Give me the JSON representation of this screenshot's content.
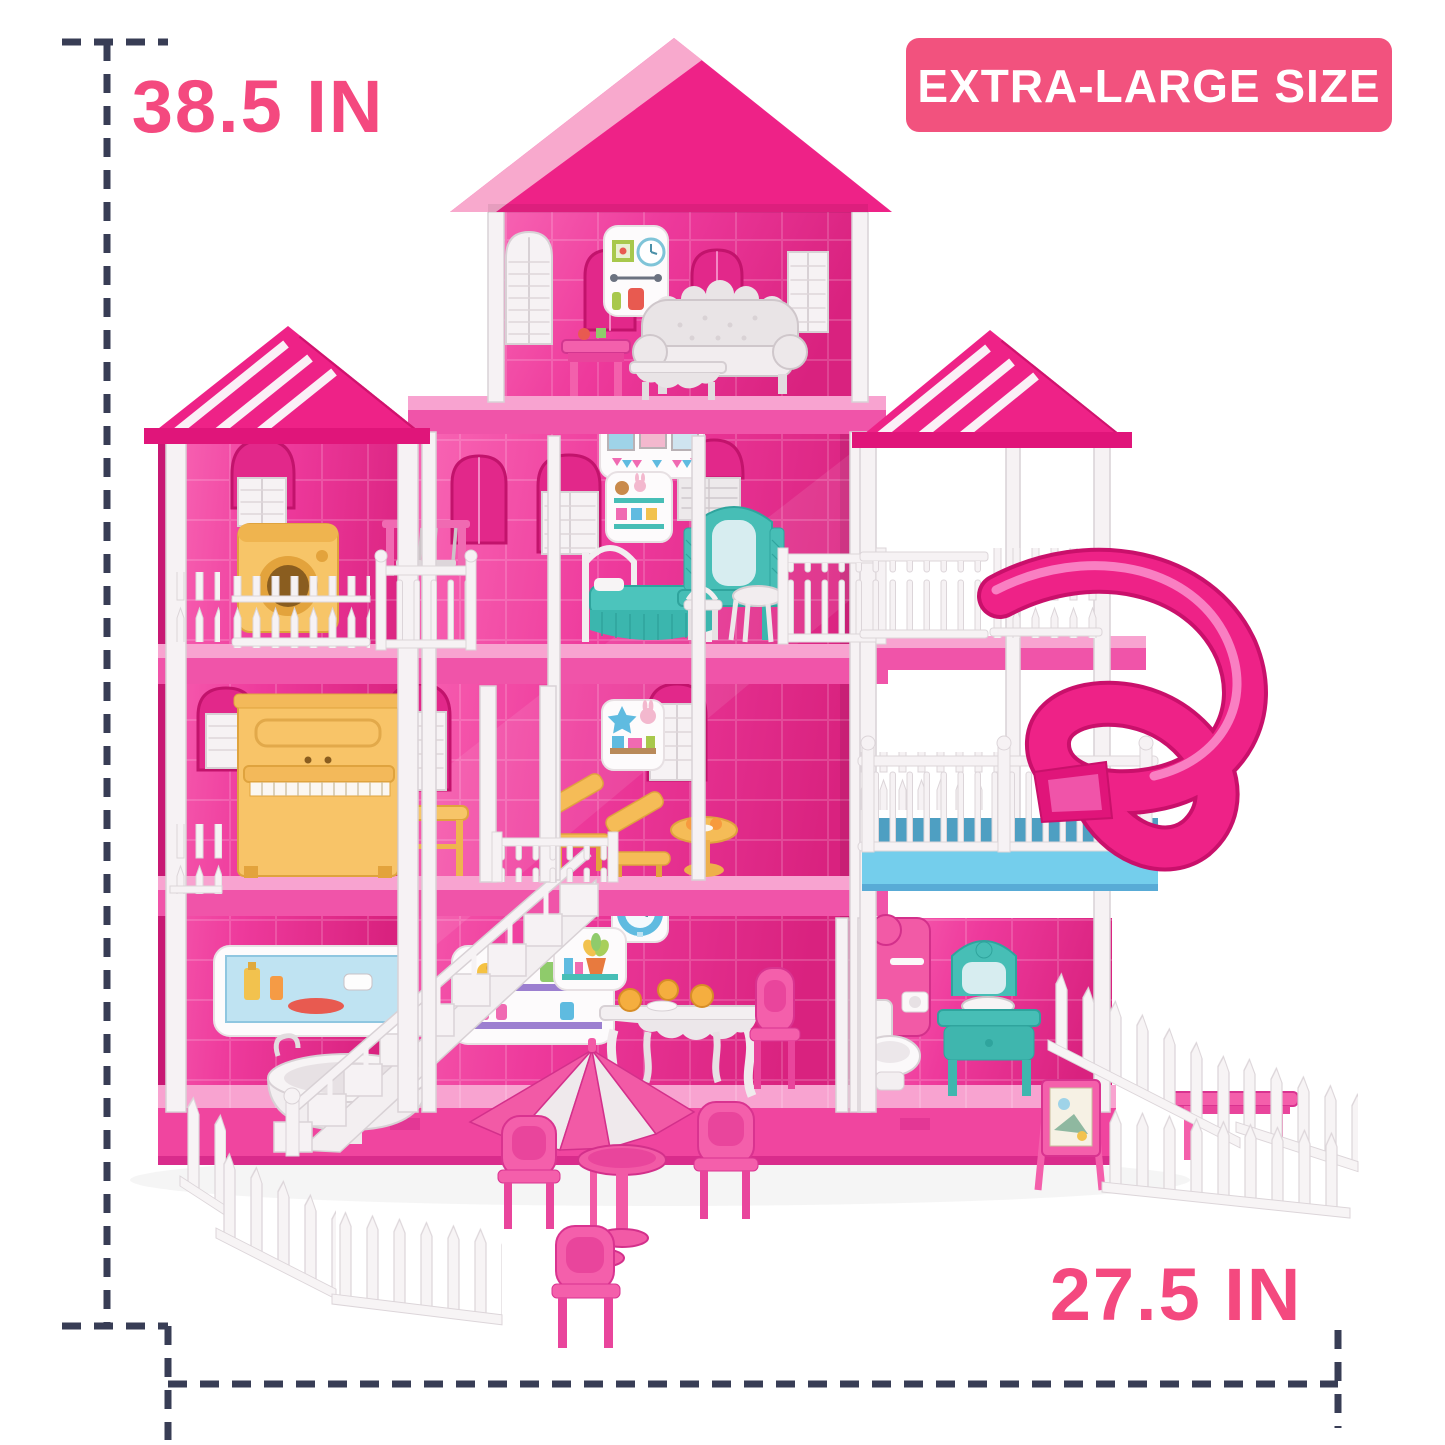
{
  "image_type": "product-photo",
  "subject": "extra-large pink 4-story dollhouse playset with furniture, spiral slide and picket fences",
  "labels": {
    "height": "38.5 IN",
    "width": "27.5 IN",
    "badge": "EXTRA-LARGE SIZE"
  },
  "poster": {
    "title": "- girl's -",
    "r": "R",
    "o1": "O",
    "o2": "O",
    "m": "M"
  },
  "colors": {
    "label_pink": "#F4497F",
    "badge_bg": "#F2527E",
    "badge_text": "#FFFFFF",
    "dash_navy": "#383D55",
    "roof_hot_pink": "#EE2287",
    "roof_fascia_light": "#F8A9CD",
    "wall_pink": "#EE3A9C",
    "slab_top_pink": "#F8A3D0",
    "slab_front_pink": "#F054A9",
    "balcony_blue": "#74CEEC",
    "slide_pink": "#EE2287",
    "furniture_yellow": "#F7C568",
    "furniture_teal": "#47BEB6",
    "furniture_white": "#F2EEF0",
    "accent_pink": "#F45FAB"
  },
  "scene_items": [
    "sofa",
    "coffee-table",
    "girls-room-poster",
    "washing-machine",
    "swing-set",
    "bed",
    "vanity",
    "stool",
    "piano",
    "piano-bench",
    "lounge-chairs",
    "staircase",
    "bathtub",
    "dining-table",
    "shower",
    "toilet",
    "sink-vanity",
    "spiral-slide",
    "patio-umbrella",
    "patio-table",
    "patio-chairs",
    "easel",
    "garden-fences"
  ]
}
